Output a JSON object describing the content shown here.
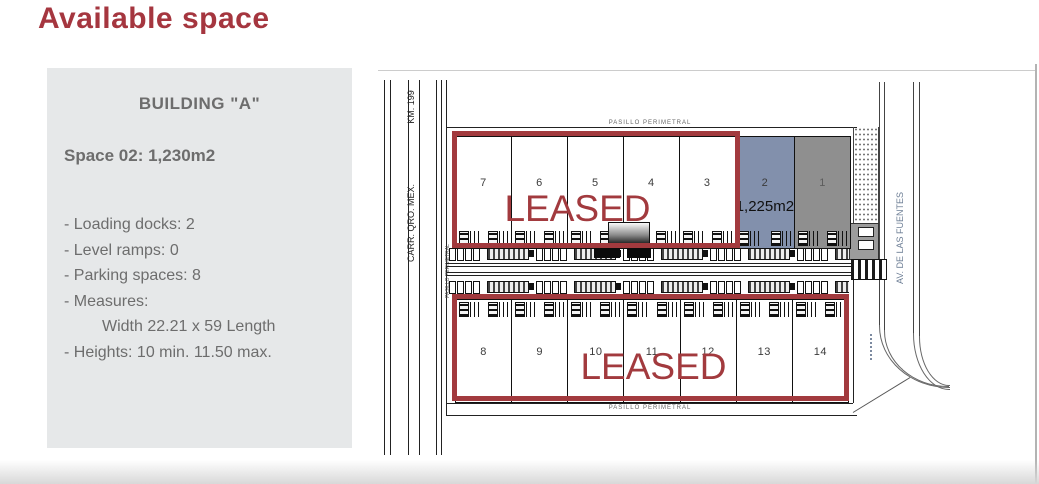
{
  "title": "Available space",
  "panel": {
    "heading": "BUILDING \"A\"",
    "space": "Space 02: 1,230m2",
    "details": [
      "- Loading docks: 2",
      "- Level ramps: 0",
      "- Parking spaces: 8",
      "- Measures:",
      "Width 22.21 x 59 Length",
      "- Heights: 10 min. 11.50 max."
    ]
  },
  "plan": {
    "road_labels": {
      "left_top": "KM. 199",
      "left_main": "CARR. QRO. MEX.",
      "right": "AV. DE LAS FUENTES"
    },
    "corridor_labels": {
      "top": "PASILLO PERIMETRAL",
      "bottom": "PASILLO PERIMETRAL",
      "left": "PASILLO PERIMETRAL"
    },
    "leased_label_top": "LEASED",
    "leased_label_bottom": "LEASED",
    "units_top": [
      "7",
      "6",
      "5",
      "4",
      "3",
      "2",
      "1"
    ],
    "units_bottom": [
      "8",
      "9",
      "10",
      "11",
      "12",
      "13",
      "14"
    ],
    "available_unit": {
      "number": "2",
      "area": "1,225m2"
    },
    "leased_dark_unit": "1",
    "colors": {
      "accent_red": "#a23a3e",
      "available_blue": "#8290ac",
      "dark_gray_unit": "#8f8f8f",
      "panel_bg": "#e6e8e9"
    }
  }
}
